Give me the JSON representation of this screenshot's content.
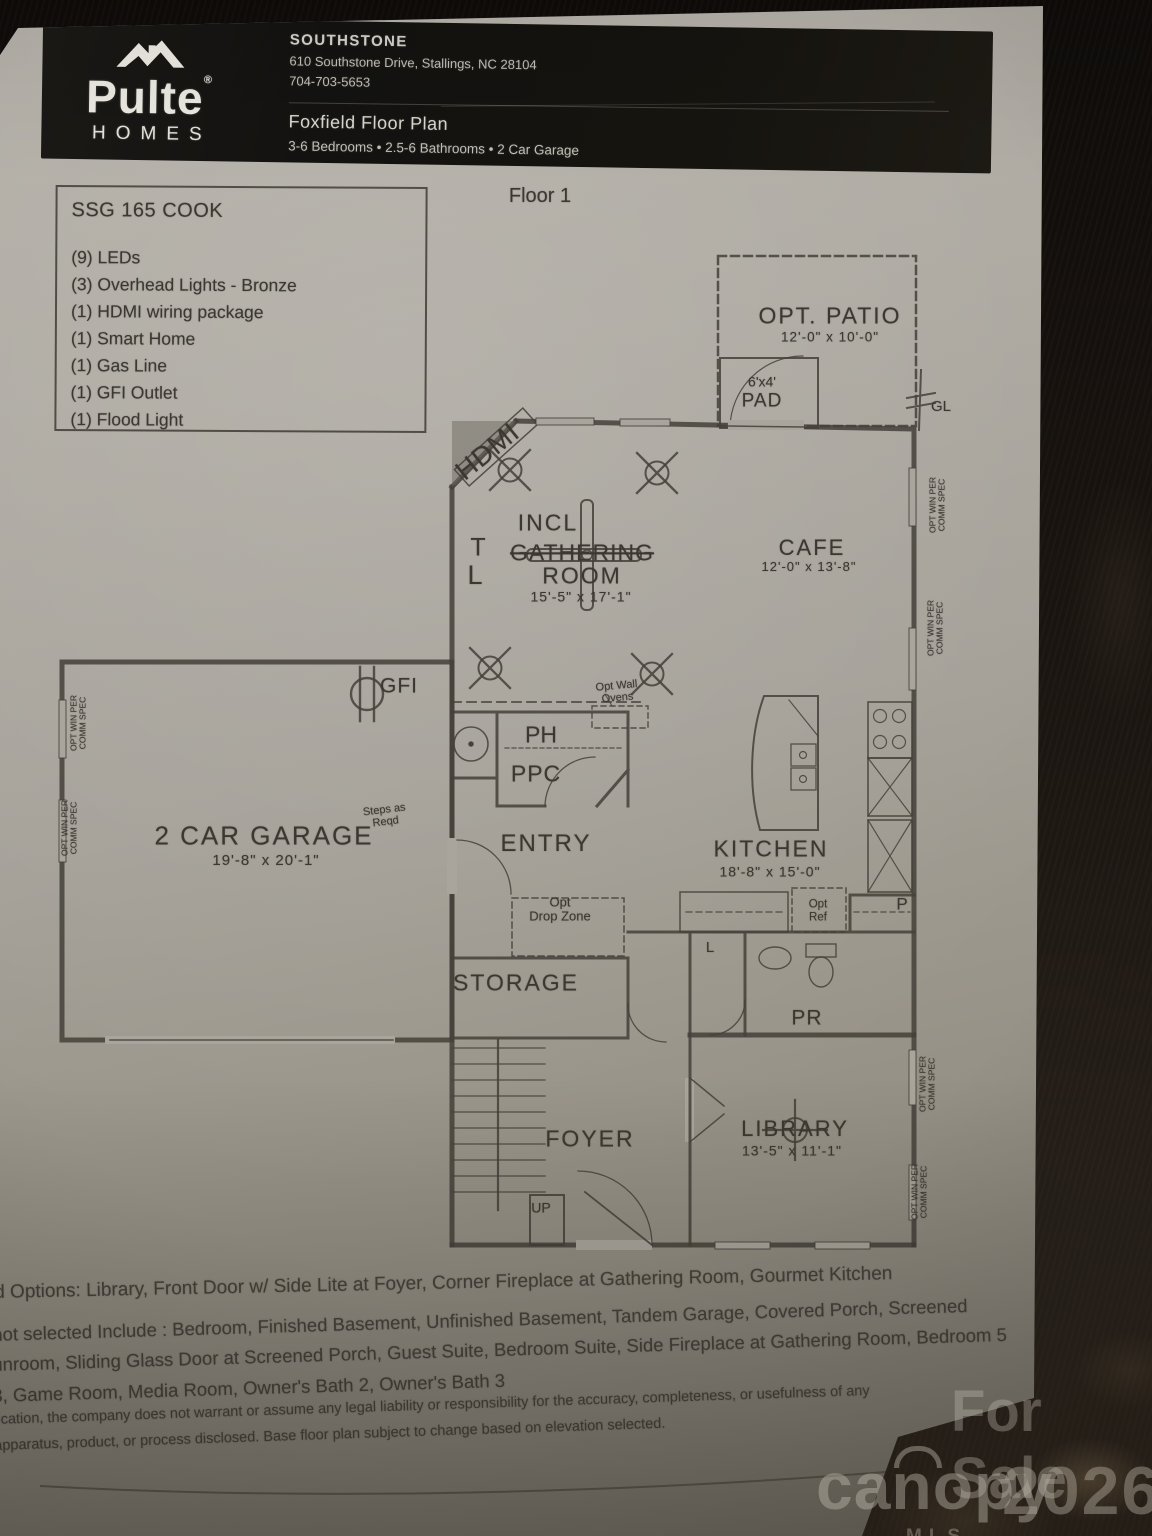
{
  "header": {
    "brand_name": "Pulte",
    "brand_reg": "®",
    "brand_sub": "HOMES",
    "community": "SOUTHSTONE",
    "address": "610 Southstone Drive, Stallings, NC 28104",
    "phone": "704-703-5653",
    "plan_title": "Foxfield Floor Plan",
    "plan_specs": "3-6 Bedrooms • 2.5-6 Bathrooms • 2 Car Garage"
  },
  "spec_box": {
    "title": "SSG 165 COOK",
    "items": [
      "(9) LEDs",
      "(3) Overhead Lights - Bronze",
      "(1) HDMI wiring package",
      "(1) Smart Home",
      "(1) Gas Line",
      "(1) GFI Outlet",
      "(1) Flood Light"
    ]
  },
  "floor_label": "Floor 1",
  "plan": {
    "patio": {
      "name": "OPT. PATIO",
      "dims": "12'-0\" x 10'-0\""
    },
    "pad": {
      "line1": "6'x4'",
      "line2": "PAD"
    },
    "gl": "GL",
    "hdmi": "HDMI",
    "incl": "INCL",
    "gathering": {
      "name1": "GATHERING",
      "name2": "ROOM",
      "dims": "15'-5\" x 17'-1\""
    },
    "t_mark": "T",
    "l_mark": "L",
    "cafe": {
      "name": "CAFE",
      "dims": "12'-0\" x 13'-8\""
    },
    "kitchen": {
      "name": "KITCHEN",
      "dims": "18'-8\" x 15'-0\""
    },
    "ph": "PH",
    "ppc": "PPC",
    "entry": "ENTRY",
    "drop_zone": {
      "line1": "Opt",
      "line2": "Drop Zone"
    },
    "wall_ovens": {
      "line1": "Opt Wall",
      "line2": "Ovens"
    },
    "gfi": "GFI",
    "garage": {
      "name": "2 CAR GARAGE",
      "dims": "19'-8\" x 20'-1\""
    },
    "steps": {
      "line1": "Steps as",
      "line2": "Reqd"
    },
    "storage": "STORAGE",
    "foyer": "FOYER",
    "up": "UP",
    "pr": "PR",
    "linen": "L",
    "pantry": "P",
    "opt_ref": {
      "line1": "Opt",
      "line2": "Ref"
    },
    "library": {
      "name": "LIBRARY",
      "dims": "13'-5\" x 11'-1\""
    },
    "opt_win": {
      "line1": "OPT WIN PER",
      "line2": "COMM SPEC"
    }
  },
  "footer": {
    "options_line": "d Options: Library, Front Door w/ Side Lite at Foyer, Corner Fireplace at Gathering Room, Gourmet Kitchen",
    "not_selected_line1": "not selected Include : Bedroom, Finished Basement, Unfinished Basement, Tandem Garage, Covered Porch, Screened",
    "not_selected_line2": "unroom, Sliding Glass Door at Screened Porch, Guest Suite, Bedroom Suite, Side Fireplace at Gathering Room, Bedroom 5",
    "not_selected_line3": "3, Game Room, Media Room, Owner's Bath 2, Owner's Bath 3",
    "disclaimer_line1": "lication, the company does not warrant or assume any legal liability or responsibility for the accuracy, completeness, or usefulness of any",
    "disclaimer_line2": "apparatus, product, or process disclosed. Base floor plan subject to change based on elevation selected."
  },
  "watermark": {
    "for_sale": "For Sale",
    "brand": "canopy",
    "brand_sub": "MLS",
    "year": "2026"
  },
  "colors": {
    "paper": "#aba79f",
    "ink": "#3b3831",
    "header_band": "#161412",
    "carpet": "#1c1712"
  }
}
